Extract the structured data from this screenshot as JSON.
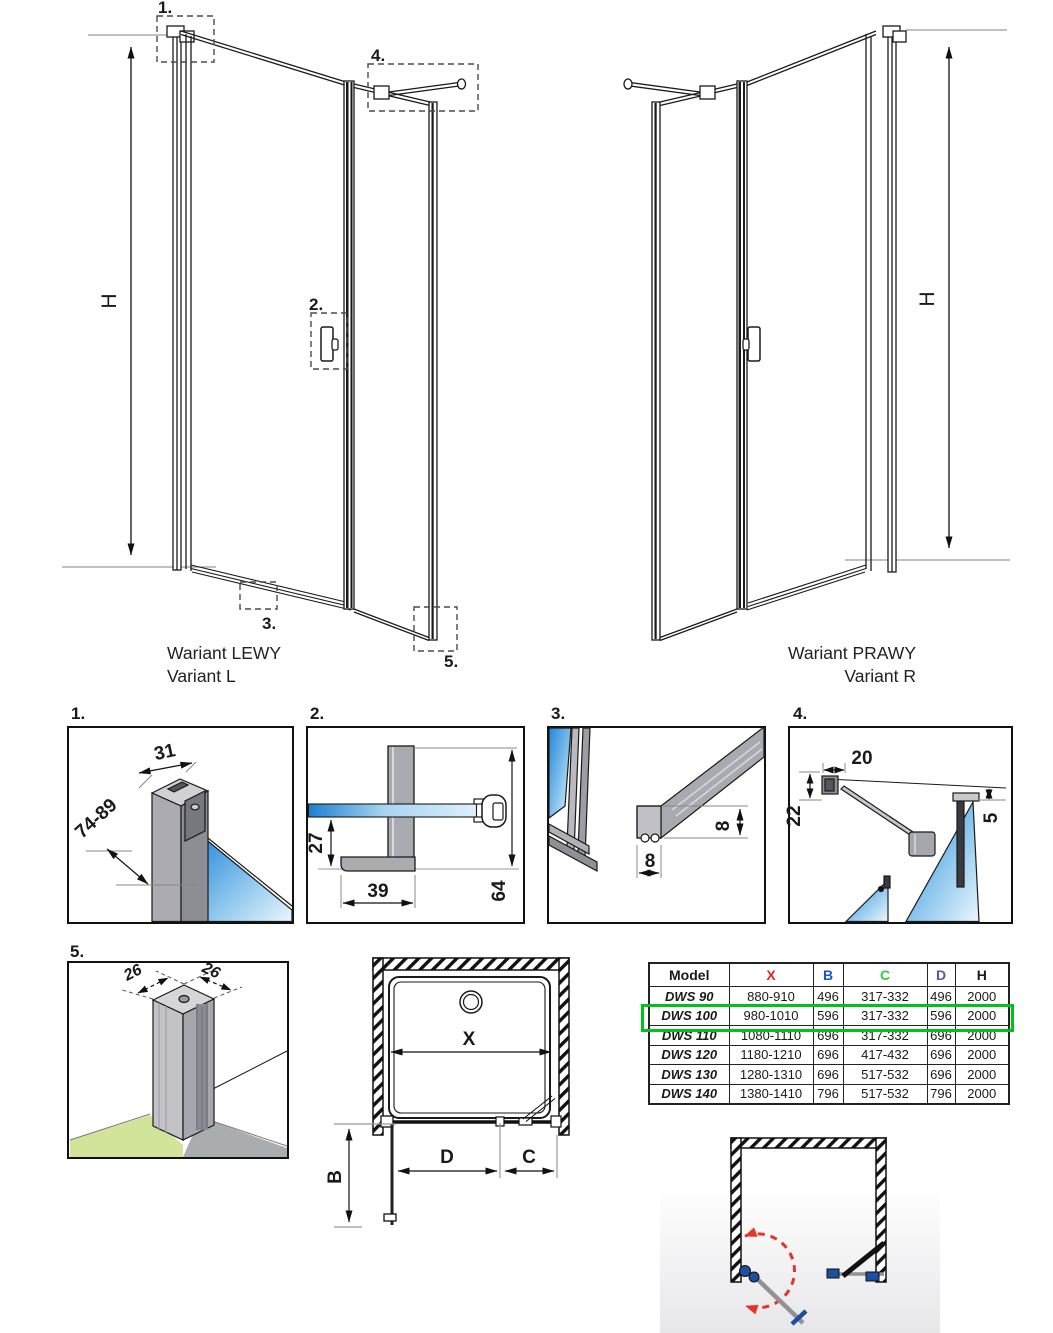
{
  "colors": {
    "x_red": "#e02420",
    "b_blue": "#1b55c4",
    "c_green": "#2fca3c",
    "d_purple": "#5e55a6",
    "highlight_green": "#00c21d",
    "glass_blue": "#2287d8",
    "accent_red": "#e73329",
    "hinge_blue": "#1d4f9e"
  },
  "variant_left": {
    "caption_line1": "Wariant LEWY",
    "caption_line2": "Variant L",
    "h_dim": "H",
    "callout_1": "1.",
    "callout_2": "2.",
    "callout_3": "3.",
    "callout_4": "4.",
    "callout_5": "5."
  },
  "variant_right": {
    "caption_line1": "Wariant PRAWY",
    "caption_line2": "Variant R",
    "h_dim": "H"
  },
  "detail_1": {
    "label": "1.",
    "dim_width": "31",
    "dim_height_range": "74-89"
  },
  "detail_2": {
    "label": "2.",
    "dim_offset": "27",
    "dim_length": "39",
    "dim_total": "64"
  },
  "detail_3": {
    "label": "3.",
    "dim_height": "8",
    "dim_width": "8"
  },
  "detail_4": {
    "label": "4.",
    "dim_bracket": "20",
    "dim_drop": "22",
    "dim_gap": "5"
  },
  "detail_5": {
    "label": "5.",
    "dim_left": "26",
    "dim_right": "26"
  },
  "plan": {
    "dim_x": "X",
    "dim_b": "B",
    "dim_c": "C",
    "dim_d": "D"
  },
  "table": {
    "headers": [
      "Model",
      "X",
      "B",
      "C",
      "D",
      "H"
    ],
    "header_colors": [
      "#1a1a1a",
      "#e02420",
      "#1b55c4",
      "#2fca3c",
      "#5e55a6",
      "#1a1a1a"
    ],
    "highlight_color": "#00c21d",
    "rows": [
      {
        "model": "DWS 90",
        "x": "880-910",
        "b": "496",
        "c": "317-332",
        "d": "496",
        "h": "2000",
        "highlighted": false
      },
      {
        "model": "DWS 100",
        "x": "980-1010",
        "b": "596",
        "c": "317-332",
        "d": "596",
        "h": "2000",
        "highlighted": true
      },
      {
        "model": "DWS 110",
        "x": "1080-1110",
        "b": "696",
        "c": "317-332",
        "d": "696",
        "h": "2000",
        "highlighted": false
      },
      {
        "model": "DWS 120",
        "x": "1180-1210",
        "b": "696",
        "c": "417-432",
        "d": "696",
        "h": "2000",
        "highlighted": false
      },
      {
        "model": "DWS 130",
        "x": "1280-1310",
        "b": "696",
        "c": "517-532",
        "d": "696",
        "h": "2000",
        "highlighted": false
      },
      {
        "model": "DWS 140",
        "x": "1380-1410",
        "b": "796",
        "c": "517-532",
        "d": "796",
        "h": "2000",
        "highlighted": false
      }
    ]
  }
}
